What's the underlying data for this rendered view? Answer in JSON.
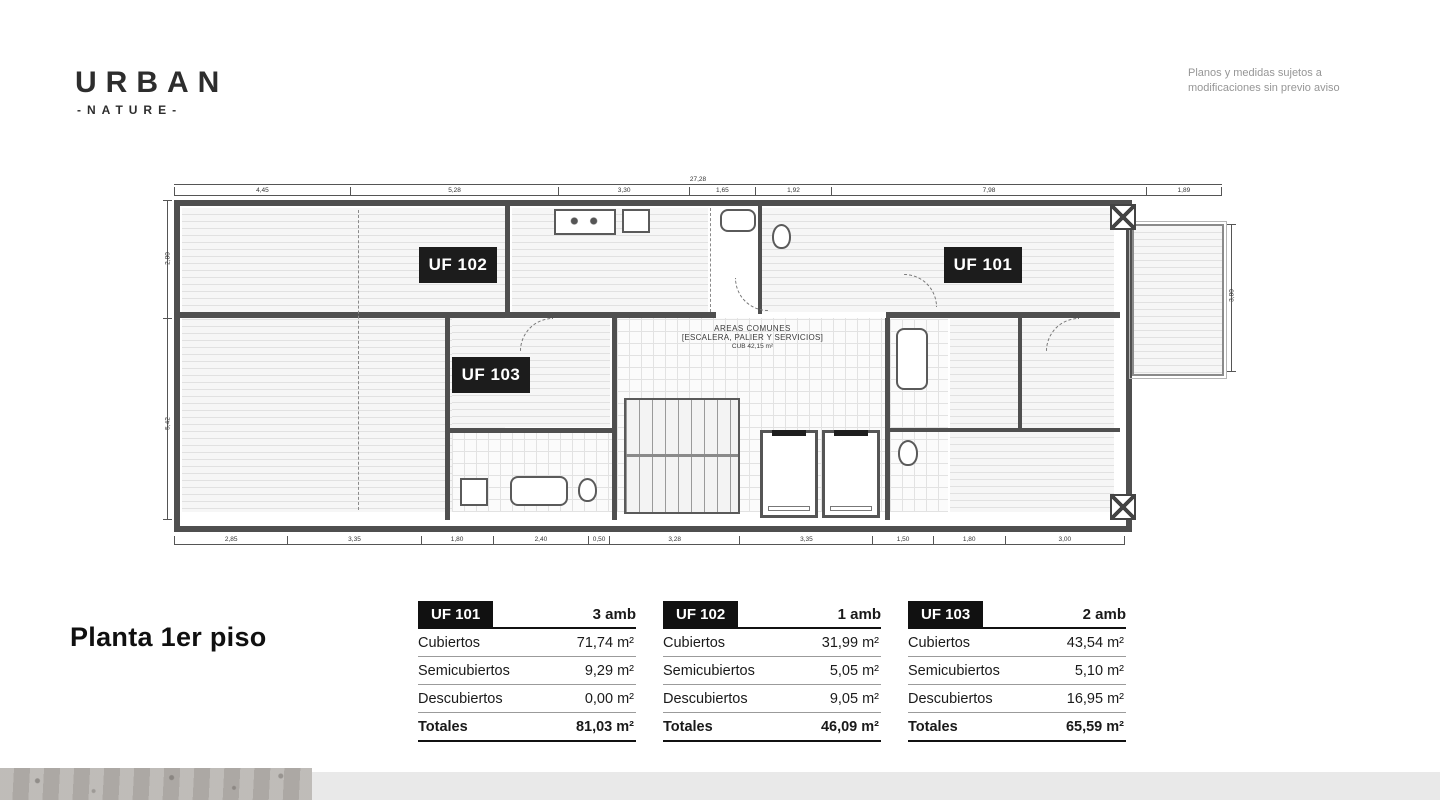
{
  "brand": {
    "name": "URBAN",
    "tagline": "-NATURE-"
  },
  "disclaimer": {
    "line1": "Planos y medidas sujetos a",
    "line2": "modificaciones sin previo aviso"
  },
  "page_title": "Planta 1er piso",
  "plan": {
    "units": {
      "uf101": "UF 101",
      "uf102": "UF 102",
      "uf103": "UF 103"
    },
    "common_area": {
      "line1": "AREAS COMUNES",
      "line2": "[ESCALERA, PALIER Y SERVICIOS]",
      "line3": "CUB 42,15 m²"
    },
    "dim_total_top": "27,28",
    "dims_top": [
      "4,45",
      "5,28",
      "3,30",
      "1,65",
      "1,92",
      "7,98",
      "1,89"
    ],
    "dims_bottom": [
      "2,85",
      "3,35",
      "1,80",
      "2,40",
      "0,50",
      "3,28",
      "3,35",
      "1,50",
      "1,80",
      "3,00"
    ],
    "dims_left": [
      "2,80",
      "5,42"
    ],
    "dims_right": [
      "3,80"
    ]
  },
  "tables": [
    {
      "unit": "UF 101",
      "amb": "3 amb",
      "rows": [
        {
          "label": "Cubiertos",
          "value": "71,74 m²"
        },
        {
          "label": "Semicubiertos",
          "value": "9,29 m²"
        },
        {
          "label": "Descubiertos",
          "value": "0,00 m²"
        }
      ],
      "total_label": "Totales",
      "total_value": "81,03 m²"
    },
    {
      "unit": "UF 102",
      "amb": "1 amb",
      "rows": [
        {
          "label": "Cubiertos",
          "value": "31,99 m²"
        },
        {
          "label": "Semicubiertos",
          "value": "5,05 m²"
        },
        {
          "label": "Descubiertos",
          "value": "9,05 m²"
        }
      ],
      "total_label": "Totales",
      "total_value": "46,09 m²"
    },
    {
      "unit": "UF 103",
      "amb": "2 amb",
      "rows": [
        {
          "label": "Cubiertos",
          "value": "43,54 m²"
        },
        {
          "label": "Semicubiertos",
          "value": "5,10 m²"
        },
        {
          "label": "Descubiertos",
          "value": "16,95 m²"
        }
      ],
      "total_label": "Totales",
      "total_value": "65,59 m²"
    }
  ],
  "colors": {
    "wall": "#4f4f4f",
    "label_bg": "#1c1c1c",
    "text": "#1a1a1a",
    "muted_text": "#969696",
    "footer_gray": "#e9e9e9",
    "concrete": "#b5b1ad"
  }
}
